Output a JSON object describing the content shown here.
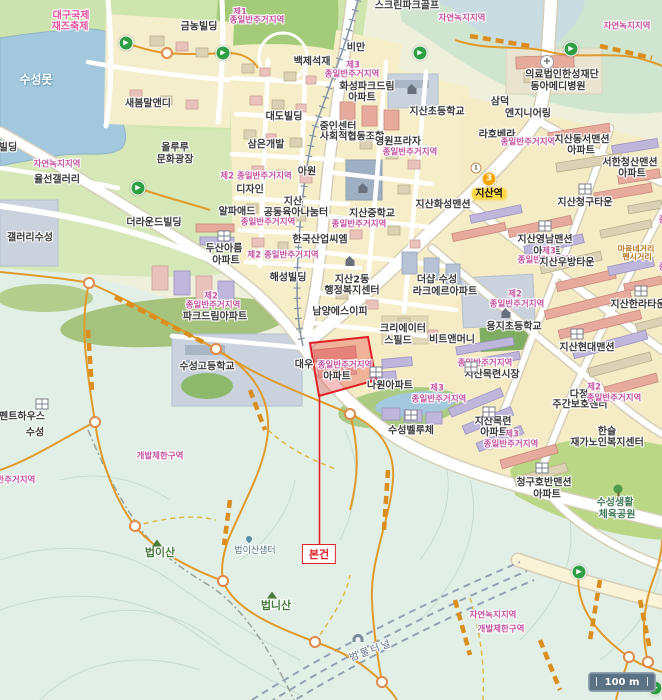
{
  "map": {
    "scale_bar": {
      "label": "100 m"
    },
    "subject": {
      "label": "본건"
    },
    "station": {
      "name": "지산역",
      "badges": [
        {
          "text": "1"
        },
        {
          "text": "3"
        }
      ]
    },
    "colors": {
      "highlight_red": "#e01f26",
      "zone_pink": "#c4509e",
      "line3_orange": "#f7a600",
      "water_blue": "#a3c8de",
      "station_highlight": "#ffd84a",
      "trail_orange": "#e09a2c"
    }
  },
  "labels": [
    {
      "text": "대구국제",
      "x": 71,
      "y": 16,
      "t": "festival"
    },
    {
      "text": "재즈축제",
      "x": 70,
      "y": 27,
      "t": "festival"
    },
    {
      "text": "수성못",
      "x": 36,
      "y": 80,
      "t": "water"
    },
    {
      "text": "금농빌딩",
      "x": 199,
      "y": 27,
      "t": "place"
    },
    {
      "text": "새봄말앤디",
      "x": 148,
      "y": 104,
      "t": "place"
    },
    {
      "text": "백제석재",
      "x": 312,
      "y": 62,
      "t": "place"
    },
    {
      "text": "비만",
      "x": 356,
      "y": 48,
      "t": "place"
    },
    {
      "text": "스크린파크골프",
      "x": 407,
      "y": 6,
      "t": "place"
    },
    {
      "text": "자연녹지지역",
      "x": 462,
      "y": 19,
      "t": "zone"
    },
    {
      "text": "자연녹지지역",
      "x": 627,
      "y": 27,
      "t": "zone"
    },
    {
      "text": "제1",
      "x": 240,
      "y": 13,
      "t": "zone"
    },
    {
      "text": "종일반주거지역",
      "x": 257,
      "y": 21,
      "t": "zone"
    },
    {
      "text": "제3",
      "x": 353,
      "y": 66,
      "t": "zone"
    },
    {
      "text": "종일반주거지역",
      "x": 352,
      "y": 75,
      "t": "zone"
    },
    {
      "text": "의료법인한성재단",
      "x": 562,
      "y": 75,
      "t": "place"
    },
    {
      "text": "동아메디병원",
      "x": 558,
      "y": 87,
      "t": "place"
    },
    {
      "text": "삼덕",
      "x": 500,
      "y": 102,
      "t": "place"
    },
    {
      "text": "엔지니어링",
      "x": 528,
      "y": 114,
      "t": "place"
    },
    {
      "text": "지산초등학교",
      "x": 437,
      "y": 112,
      "t": "place"
    },
    {
      "text": "화성파크드림",
      "x": 367,
      "y": 87,
      "t": "place"
    },
    {
      "text": "아파트",
      "x": 362,
      "y": 98,
      "t": "place"
    },
    {
      "text": "대도빌딩",
      "x": 284,
      "y": 117,
      "t": "place"
    },
    {
      "text": "중인센터",
      "x": 338,
      "y": 127,
      "t": "place"
    },
    {
      "text": "사회적협동조합",
      "x": 352,
      "y": 137,
      "t": "place"
    },
    {
      "text": "영원프라자",
      "x": 398,
      "y": 142,
      "t": "place"
    },
    {
      "text": "종일반주거지역",
      "x": 410,
      "y": 153,
      "t": "zone"
    },
    {
      "text": "삼은개발",
      "x": 266,
      "y": 145,
      "t": "place"
    },
    {
      "text": "제2 종일반주거지역",
      "x": 256,
      "y": 177,
      "t": "zone"
    },
    {
      "text": "디자인",
      "x": 250,
      "y": 190,
      "t": "place"
    },
    {
      "text": "아원",
      "x": 307,
      "y": 172,
      "t": "place"
    },
    {
      "text": "라호베라",
      "x": 497,
      "y": 135,
      "t": "place"
    },
    {
      "text": "종일반주거지역",
      "x": 528,
      "y": 143,
      "t": "zone"
    },
    {
      "text": "지산동서맨션",
      "x": 582,
      "y": 140,
      "t": "place"
    },
    {
      "text": "아파트",
      "x": 581,
      "y": 151,
      "t": "place"
    },
    {
      "text": "서한청산맨션",
      "x": 630,
      "y": 163,
      "t": "place"
    },
    {
      "text": "아파트",
      "x": 632,
      "y": 174,
      "t": "place"
    },
    {
      "text": "지산",
      "x": 293,
      "y": 202,
      "t": "place"
    },
    {
      "text": "공동육아나눔터",
      "x": 296,
      "y": 213,
      "t": "place"
    },
    {
      "text": "알파애드",
      "x": 237,
      "y": 212,
      "t": "place"
    },
    {
      "text": "지산중학교",
      "x": 372,
      "y": 214,
      "t": "place"
    },
    {
      "text": "종일반주거지역",
      "x": 359,
      "y": 225,
      "t": "zone"
    },
    {
      "text": "지산화성맨션",
      "x": 443,
      "y": 205,
      "t": "place"
    },
    {
      "text": "종일반주거지역",
      "x": 268,
      "y": 223,
      "t": "zone"
    },
    {
      "text": "한국산업씨엠",
      "x": 320,
      "y": 240,
      "t": "place"
    },
    {
      "text": "제2 종일반주거지역",
      "x": 283,
      "y": 256,
      "t": "zone"
    },
    {
      "text": "지산청구타운",
      "x": 585,
      "y": 203,
      "t": "place"
    },
    {
      "text": "지산영남맨션",
      "x": 545,
      "y": 240,
      "t": "place"
    },
    {
      "text": "아파트",
      "x": 547,
      "y": 252,
      "t": "place"
    },
    {
      "text": "제3",
      "x": 549,
      "y": 252,
      "t": "zone"
    },
    {
      "text": "종일반주거지역",
      "x": 545,
      "y": 261,
      "t": "zone"
    },
    {
      "text": "지산우방타운",
      "x": 567,
      "y": 263,
      "t": "place"
    },
    {
      "text": "지산한라타운",
      "x": 638,
      "y": 305,
      "t": "place"
    },
    {
      "text": "지산동",
      "x": 680,
      "y": 200,
      "t": "place"
    },
    {
      "text": "행정복지",
      "x": 680,
      "y": 212,
      "t": "place"
    },
    {
      "text": "종일반주거지역",
      "x": 686,
      "y": 221,
      "t": "zone"
    },
    {
      "text": "종일반주거지역",
      "x": 686,
      "y": 268,
      "t": "zone"
    },
    {
      "text": "마을네거리",
      "x": 636,
      "y": 250,
      "t": "orange"
    },
    {
      "text": "펜시거리",
      "x": 637,
      "y": 258,
      "t": "orange"
    },
    {
      "text": "두산아름",
      "x": 224,
      "y": 249,
      "t": "place"
    },
    {
      "text": "아파트",
      "x": 226,
      "y": 261,
      "t": "place"
    },
    {
      "text": "해성빌딩",
      "x": 288,
      "y": 278,
      "t": "place"
    },
    {
      "text": "지산2동",
      "x": 352,
      "y": 280,
      "t": "place"
    },
    {
      "text": "행정복지센터",
      "x": 352,
      "y": 291,
      "t": "place"
    },
    {
      "text": "더샵 수성",
      "x": 437,
      "y": 280,
      "t": "place"
    },
    {
      "text": "라크에르아파트",
      "x": 445,
      "y": 292,
      "t": "place"
    },
    {
      "text": "남양에스이피",
      "x": 340,
      "y": 312,
      "t": "place"
    },
    {
      "text": "크리에이터",
      "x": 403,
      "y": 329,
      "t": "place"
    },
    {
      "text": "스필드",
      "x": 398,
      "y": 341,
      "t": "place"
    },
    {
      "text": "비트앤머니",
      "x": 452,
      "y": 340,
      "t": "place"
    },
    {
      "text": "용지초등학교",
      "x": 514,
      "y": 327,
      "t": "place"
    },
    {
      "text": "제2",
      "x": 515,
      "y": 295,
      "t": "zone"
    },
    {
      "text": "종일반주거지역",
      "x": 517,
      "y": 305,
      "t": "zone"
    },
    {
      "text": "지산현대맨션",
      "x": 587,
      "y": 348,
      "t": "place"
    },
    {
      "text": "지산목련시장",
      "x": 492,
      "y": 375,
      "t": "place"
    },
    {
      "text": "종일반주거지역",
      "x": 485,
      "y": 364,
      "t": "zone"
    },
    {
      "text": "다정",
      "x": 579,
      "y": 395,
      "t": "place"
    },
    {
      "text": "주간보호센터",
      "x": 580,
      "y": 405,
      "t": "place"
    },
    {
      "text": "제2",
      "x": 594,
      "y": 388,
      "t": "zone"
    },
    {
      "text": "종일반주거지역",
      "x": 614,
      "y": 399,
      "t": "zone"
    },
    {
      "text": "파크드림아파트",
      "x": 215,
      "y": 317,
      "t": "place"
    },
    {
      "text": "제2",
      "x": 211,
      "y": 297,
      "t": "zone"
    },
    {
      "text": "종일반주거지역",
      "x": 213,
      "y": 306,
      "t": "zone"
    },
    {
      "text": "수성고등학교",
      "x": 207,
      "y": 367,
      "t": "place"
    },
    {
      "text": "대우",
      "x": 304,
      "y": 365,
      "t": "place"
    },
    {
      "text": "아파트",
      "x": 337,
      "y": 377,
      "t": "place"
    },
    {
      "text": "종일반주거지역",
      "x": 345,
      "y": 366,
      "t": "zone"
    },
    {
      "text": "나원아파트",
      "x": 390,
      "y": 386,
      "t": "place"
    },
    {
      "text": "제3",
      "x": 437,
      "y": 389,
      "t": "zone"
    },
    {
      "text": "종일반주거지역",
      "x": 439,
      "y": 400,
      "t": "zone"
    },
    {
      "text": "수성벨루체",
      "x": 411,
      "y": 431,
      "t": "place"
    },
    {
      "text": "지산목련",
      "x": 493,
      "y": 422,
      "t": "place"
    },
    {
      "text": "아파트",
      "x": 494,
      "y": 433,
      "t": "place"
    },
    {
      "text": "제3",
      "x": 512,
      "y": 435,
      "t": "zone"
    },
    {
      "text": "종일반주거지역",
      "x": 511,
      "y": 445,
      "t": "zone"
    },
    {
      "text": "한슬",
      "x": 607,
      "y": 432,
      "t": "place"
    },
    {
      "text": "재가노인복지센터",
      "x": 607,
      "y": 443,
      "t": "place"
    },
    {
      "text": "청구호반맨션",
      "x": 544,
      "y": 483,
      "t": "place"
    },
    {
      "text": "아파트",
      "x": 547,
      "y": 495,
      "t": "place"
    },
    {
      "text": "수성생활",
      "x": 615,
      "y": 503,
      "t": "park"
    },
    {
      "text": "체육공원",
      "x": 617,
      "y": 515,
      "t": "park"
    },
    {
      "text": "갤러리수성",
      "x": 30,
      "y": 238,
      "t": "place"
    },
    {
      "text": "더라운드빌딩",
      "x": 154,
      "y": 223,
      "t": "place"
    },
    {
      "text": "율선갤러리",
      "x": 57,
      "y": 180,
      "t": "place"
    },
    {
      "text": "자연녹지지역",
      "x": 57,
      "y": 165,
      "t": "zone"
    },
    {
      "text": "올루루",
      "x": 175,
      "y": 148,
      "t": "place"
    },
    {
      "text": "문화광장",
      "x": 175,
      "y": 160,
      "t": "place"
    },
    {
      "text": "빌딩",
      "x": 8,
      "y": 148,
      "t": "place"
    },
    {
      "text": "펜트하우스",
      "x": 22,
      "y": 417,
      "t": "place"
    },
    {
      "text": "수성",
      "x": 35,
      "y": 433,
      "t": "place"
    },
    {
      "text": "종일반주거지역",
      "x": 8,
      "y": 481,
      "t": "zone"
    },
    {
      "text": "개발제한구역",
      "x": 160,
      "y": 457,
      "t": "zone"
    },
    {
      "text": "법이산샘터",
      "x": 255,
      "y": 552,
      "t": "spring"
    },
    {
      "text": "법이산",
      "x": 160,
      "y": 553,
      "t": "mtn"
    },
    {
      "text": "법니산",
      "x": 276,
      "y": 606,
      "t": "mtn"
    },
    {
      "text": "범물터널",
      "x": 371,
      "y": 651,
      "t": "tunnel",
      "rot": -20
    },
    {
      "text": "자연녹지지역",
      "x": 493,
      "y": 616,
      "t": "zone"
    },
    {
      "text": "개발제한구역",
      "x": 501,
      "y": 630,
      "t": "zone"
    },
    {
      "text": "지산역",
      "x": 489,
      "y": 194,
      "t": "station"
    }
  ],
  "markers": {
    "trailheads": [
      [
        126,
        43
      ],
      [
        223,
        53
      ],
      [
        420,
        53
      ],
      [
        571,
        49
      ],
      [
        138,
        188
      ],
      [
        579,
        572
      ],
      [
        655,
        688
      ]
    ],
    "trail_nodes": [
      [
        167,
        53
      ],
      [
        89,
        283
      ],
      [
        216,
        349
      ],
      [
        95,
        422
      ],
      [
        350,
        414
      ],
      [
        135,
        526
      ],
      [
        223,
        581
      ],
      [
        315,
        642
      ],
      [
        382,
        682
      ],
      [
        629,
        657
      ],
      [
        648,
        662
      ]
    ],
    "apartment_icons": [
      [
        224,
        236
      ],
      [
        585,
        189
      ],
      [
        545,
        226
      ],
      [
        641,
        291
      ],
      [
        577,
        334
      ],
      [
        471,
        367
      ],
      [
        376,
        372
      ],
      [
        411,
        415
      ],
      [
        542,
        468
      ],
      [
        489,
        412
      ],
      [
        42,
        404
      ]
    ],
    "house_icons": [
      [
        412,
        91
      ],
      [
        363,
        190
      ],
      [
        506,
        315
      ],
      [
        350,
        263
      ]
    ],
    "mountain_icons": [
      [
        157,
        543
      ],
      [
        272,
        595
      ]
    ],
    "tree_icons": [
      [
        618,
        489
      ]
    ],
    "hospital_icons": [
      [
        547,
        62
      ]
    ],
    "tunnel_icons": [
      [
        358,
        638
      ]
    ],
    "spring_icons": [
      [
        249,
        539
      ]
    ]
  }
}
